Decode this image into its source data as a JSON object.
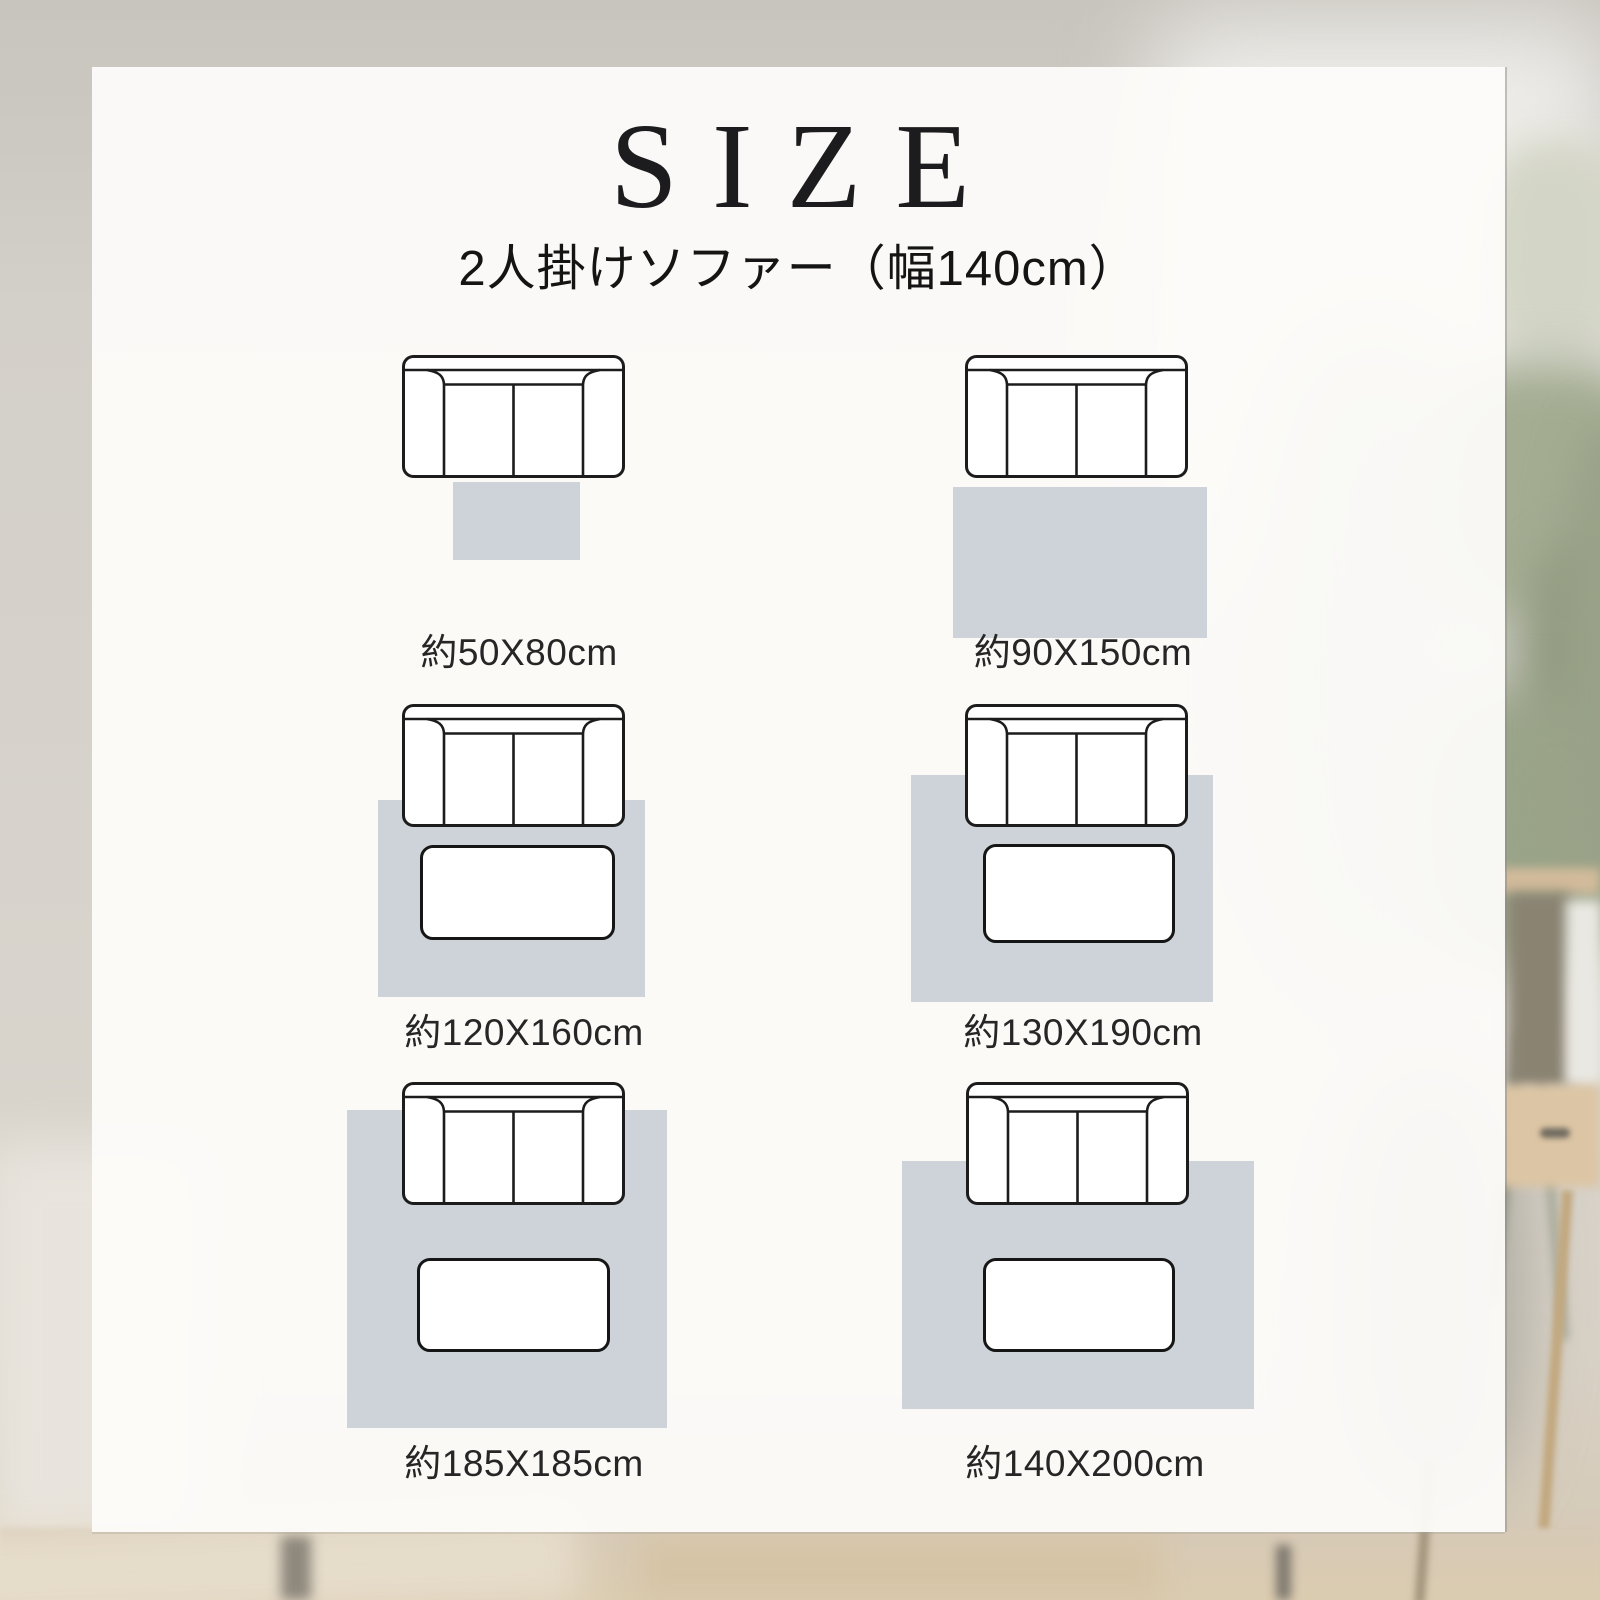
{
  "header": {
    "title": "SIZE",
    "subtitle": "2人掛けソファー（幅140cm）"
  },
  "diagrams": [
    {
      "rug_size_label": "約50X80cm",
      "has_table": false
    },
    {
      "rug_size_label": "約90X150cm",
      "has_table": false
    },
    {
      "rug_size_label": "約120X160cm",
      "has_table": true
    },
    {
      "rug_size_label": "約130X190cm",
      "has_table": true
    },
    {
      "rug_size_label": "約185X185cm",
      "has_table": true
    },
    {
      "rug_size_label": "約140X200cm",
      "has_table": true
    }
  ],
  "colors": {
    "rug_fill": "#cdd3d8",
    "outline": "#1c1c1c",
    "panel_bg": "#fdfcfa",
    "text": "#262626"
  }
}
